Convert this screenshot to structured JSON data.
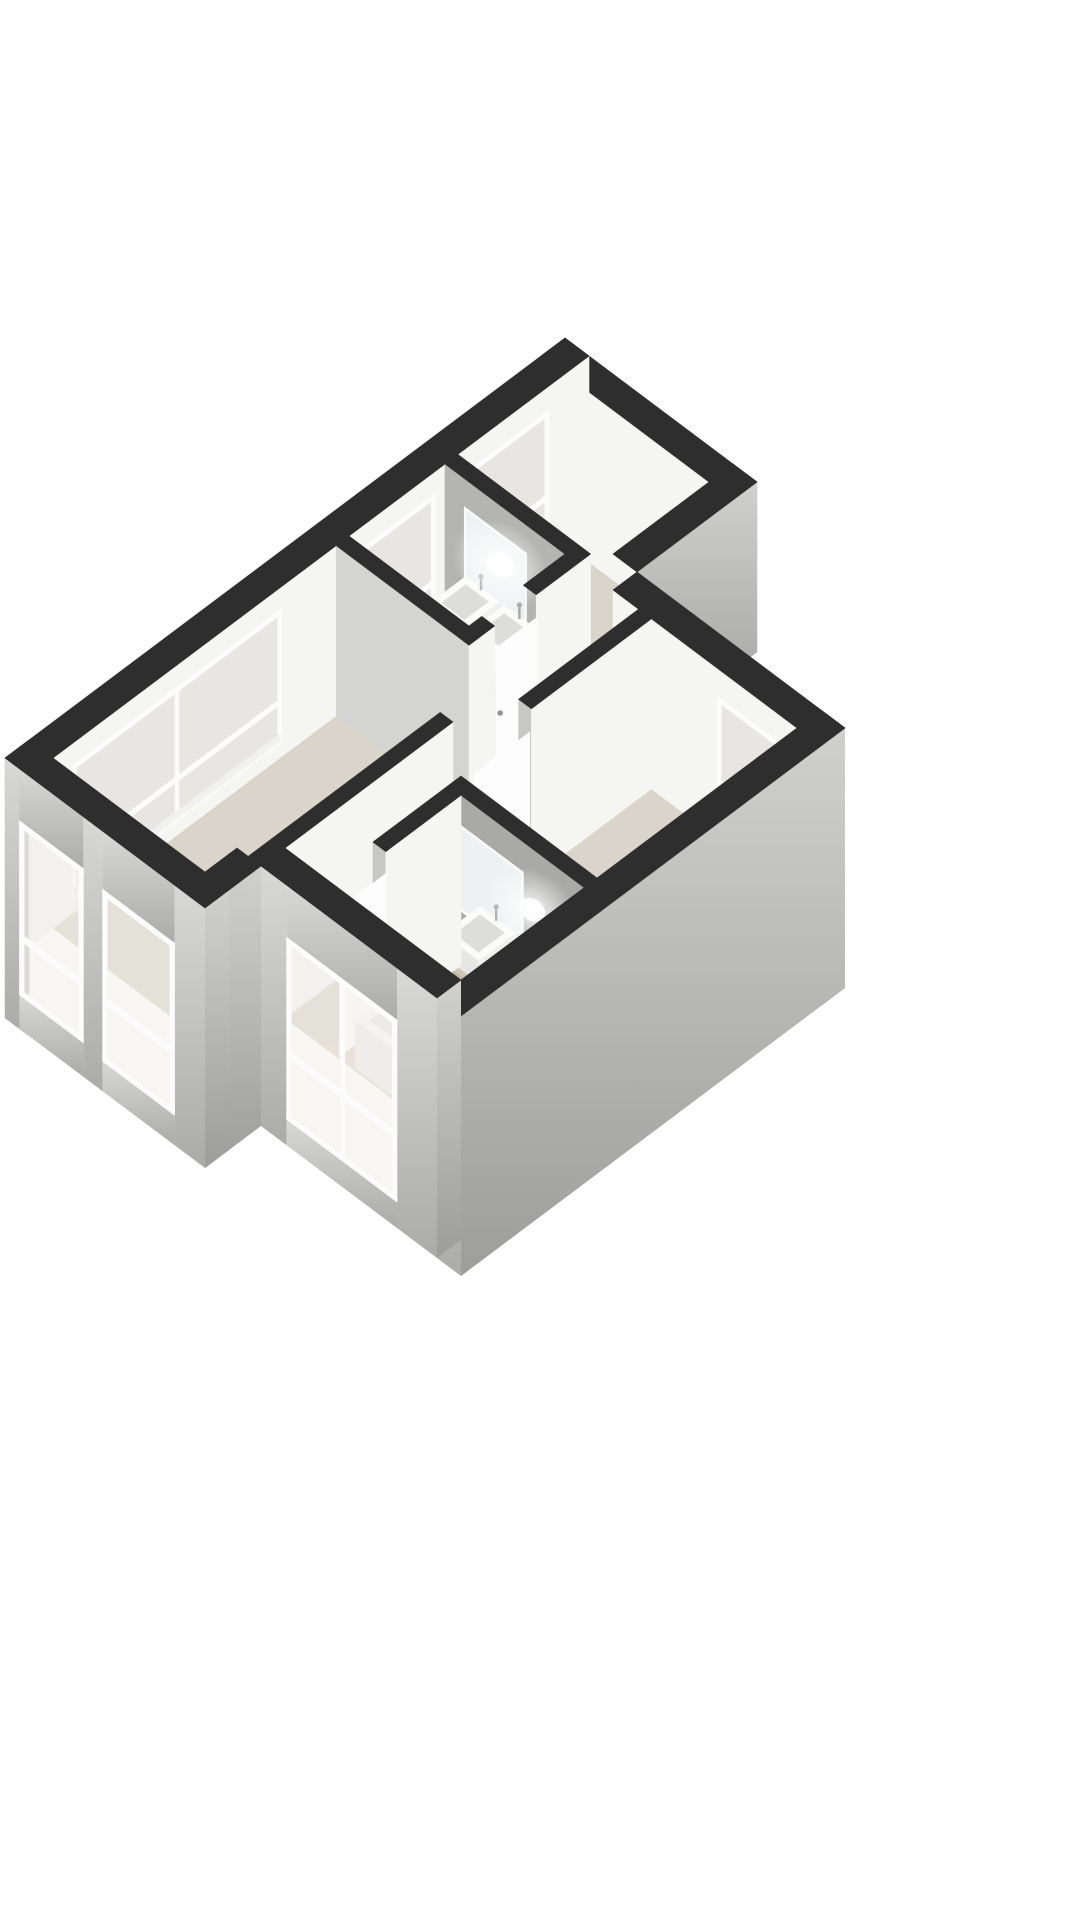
{
  "meta": {
    "title": "3D isometric floor plan render",
    "subject": "apartment floor with two bedrooms, living room, hallway and two bathrooms",
    "background": "#ffffff"
  },
  "palette": {
    "bg": "#ffffff",
    "wallTop": "#2e2e2e",
    "intWhite": "#f5f5f4",
    "intV": "#c7c7c6",
    "hallWall": "#d4d4d3",
    "bathWallA": "#b4b4b3",
    "bathWallB": "#a9a9a8",
    "extFlat": "#c9c9c8",
    "extUTop": "#d0d0cf",
    "extUBot": "#9d9d9c",
    "extVTop": "#d8d8d7",
    "extVBot": "#ababaa",
    "floor": "#d9d5ca",
    "floorBath": "#ded9cf",
    "glass": "#e7e6e2",
    "glassOut": "#efede8",
    "frame": "#fcfcfc",
    "sill": "#f1f1ef",
    "mirror": "#eef1f2",
    "mirrorFrame": "#fafafa",
    "counter": "#cfc8b4",
    "counterEdge": "#c1baa6",
    "cabinet": "#e7e2d5",
    "sinkTop": "#fbfbfa",
    "sinkSide": "#f0f0ef",
    "sinkFront": "#e7e7e6",
    "basin": "#dddddb",
    "door": "#fdfdfd",
    "handle": "#949493",
    "tubTop": "#f8f8f7",
    "tubInner": "#e9e9e8",
    "tubSide": "#f1f1f0",
    "tubFront": "#ededec",
    "towel": "#c9c9c8",
    "towelDark": "#b9b9b8",
    "faucet": "#a8a8a7",
    "glow": "#ffffff"
  },
  "scene": {
    "x0": 565,
    "y0": 338,
    "ax": 0.8,
    "ay": 0.6,
    "h": 170,
    "below": 90
  },
  "floors": [
    {
      "t": "floor",
      "name": "floor-bedroom-1",
      "r": [
        30,
        30,
        210,
        164
      ],
      "c": "floor"
    },
    {
      "t": "floor",
      "name": "floor-bathroom-1",
      "r": [
        30,
        180,
        180,
        300
      ],
      "c": "floorBath"
    },
    {
      "t": "floor",
      "name": "floor-hallway",
      "r": [
        180,
        164,
        316,
        446
      ],
      "c": "floor"
    },
    {
      "t": "floor",
      "name": "floor-bedroom-2",
      "r": [
        256,
        180,
        470,
        430
      ],
      "c": "floor"
    },
    {
      "t": "floor",
      "name": "floor-living-room",
      "r": [
        30,
        316,
        234,
        670
      ],
      "c": "floor"
    },
    {
      "t": "floor",
      "name": "floor-bathroom-2",
      "r": [
        300,
        430,
        470,
        600
      ],
      "c": "floorBath"
    },
    {
      "t": "floor",
      "name": "floor-corridor",
      "r": [
        234,
        446,
        300,
        600
      ],
      "c": "floor"
    }
  ],
  "elements": [
    {
      "t": "wall",
      "name": "wall-northeast",
      "r": [
        0,
        0,
        240,
        30
      ],
      "fv": "intWhite",
      "fu": "extFlat"
    },
    {
      "t": "wall",
      "name": "wall-northwest-facade",
      "r": [
        0,
        0,
        30,
        700
      ],
      "fu": "intWhite",
      "fv": "extFlat",
      "fvz": [
        -90,
        170
      ]
    },
    {
      "t": "winI",
      "name": "window-bedroom-1",
      "plane": "u",
      "at": 30,
      "a": [
        50,
        150
      ],
      "z": [
        26,
        146
      ],
      "transom": 60
    },
    {
      "t": "winI",
      "name": "window-bathroom-1",
      "plane": "u",
      "at": 30,
      "a": [
        192,
        292
      ],
      "z": [
        18,
        148
      ],
      "transom": 60
    },
    {
      "t": "winI",
      "name": "window-living-room",
      "plane": "u",
      "at": 30,
      "a": [
        384,
        646
      ],
      "z": [
        14,
        148
      ],
      "transom": 56,
      "mull": 515
    },
    {
      "t": "wall",
      "name": "wall-notch-east",
      "r": [
        210,
        0,
        240,
        150
      ],
      "fu": "gExtU"
    },
    {
      "t": "wall",
      "name": "wall-bedroom-2-north",
      "r": [
        240,
        150,
        500,
        180
      ],
      "fv": "intWhite",
      "fu": "gExtU",
      "fuz": [
        -90,
        170
      ]
    },
    {
      "t": "winI",
      "name": "window-bedroom-2",
      "plane": "v",
      "at": 180,
      "a": [
        370,
        455
      ],
      "z": [
        28,
        142
      ],
      "transom": 58
    },
    {
      "t": "wall",
      "name": "wall-bathroom-1-vanity",
      "r": [
        30,
        164,
        196,
        180
      ],
      "fv": "bathWallA",
      "fu": "intWhite"
    },
    {
      "t": "panel",
      "name": "mirror-bathroom-1",
      "plane": "v",
      "at": 181,
      "a": [
        58,
        130
      ],
      "z": [
        60,
        140
      ],
      "c": "mirror",
      "frame": true
    },
    {
      "t": "hpanel",
      "name": "counter-bathroom-1",
      "r": [
        50,
        180,
        152,
        238
      ],
      "z": 56,
      "c": "counter"
    },
    {
      "t": "panel",
      "name": "counter-edge-bathroom-1",
      "plane": "v",
      "at": 238,
      "a": [
        50,
        152
      ],
      "z": [
        46,
        56
      ],
      "c": "counterEdge"
    },
    {
      "t": "panel",
      "name": "cabinet-bathroom-1",
      "plane": "v",
      "at": 238,
      "a": [
        54,
        148
      ],
      "z": [
        12,
        46
      ],
      "c": "cabinet"
    },
    {
      "t": "box",
      "name": "sink-bathroom-1-left",
      "r": [
        60,
        184,
        102,
        228
      ],
      "z": [
        56,
        78
      ],
      "ct": "sinkTop",
      "cu": "sinkSide",
      "cv": "sinkFront",
      "inset": 7,
      "ci": "basin"
    },
    {
      "t": "box",
      "name": "sink-bathroom-1-right",
      "r": [
        108,
        184,
        150,
        228
      ],
      "z": [
        56,
        78
      ],
      "ct": "sinkTop",
      "cu": "sinkSide",
      "cv": "sinkFront",
      "inset": 7,
      "ci": "basin"
    },
    {
      "t": "faucet",
      "name": "faucet-icon",
      "u": 81,
      "v": 186
    },
    {
      "t": "faucet",
      "name": "faucet-icon",
      "u": 129,
      "v": 186
    },
    {
      "t": "glow",
      "name": "spotlight-bathroom-1",
      "u": 100,
      "v": 181,
      "z": 112,
      "rx": 52,
      "ry": 40,
      "rot": 37
    },
    {
      "t": "wall",
      "name": "wall-bathroom-1-south",
      "r": [
        30,
        300,
        196,
        316
      ],
      "fv": "hallWall",
      "fu": "intWhite"
    },
    {
      "t": "wall",
      "name": "wall-bathroom-1-east-a",
      "r": [
        180,
        180,
        196,
        232
      ],
      "fu": "intWhite"
    },
    {
      "t": "wall",
      "name": "wall-bathroom-1-east-b",
      "r": [
        180,
        284,
        196,
        300
      ],
      "fu": "intWhite"
    },
    {
      "t": "panel",
      "name": "door-bathroom-1",
      "plane": "u",
      "at": 197,
      "a": [
        232,
        284
      ],
      "z": [
        0,
        148
      ],
      "c": "door"
    },
    {
      "t": "handle",
      "name": "door-handle-icon",
      "u": 197,
      "v": 278,
      "z": 80
    },
    {
      "t": "wall",
      "name": "wall-bedroom-2-west",
      "r": [
        272,
        180,
        288,
        330
      ],
      "fu": "intWhite",
      "fv": "intV"
    },
    {
      "t": "panel",
      "name": "door-bedroom-2",
      "plane": "u",
      "at": 288,
      "a": [
        332,
        402
      ],
      "z": [
        0,
        148
      ],
      "c": "door"
    },
    {
      "t": "handle",
      "name": "door-handle-icon",
      "u": 288,
      "v": 396,
      "z": 80
    },
    {
      "t": "wall",
      "name": "wall-living-east",
      "r": [
        234,
        390,
        250,
        670
      ],
      "fu": "intWhite",
      "fv": "intV"
    },
    {
      "t": "wall",
      "name": "wall-bathroom-2-vanity",
      "r": [
        300,
        430,
        470,
        446
      ],
      "fv": "bathWallB"
    },
    {
      "t": "panel",
      "name": "mirror-bathroom-2",
      "plane": "v",
      "at": 447,
      "a": [
        318,
        392
      ],
      "z": [
        58,
        138
      ],
      "c": "mirror",
      "frame": true
    },
    {
      "t": "hpanel",
      "name": "counter-bathroom-2",
      "r": [
        336,
        446,
        462,
        502
      ],
      "z": 56,
      "c": "counter"
    },
    {
      "t": "panel",
      "name": "counter-edge-bathroom-2",
      "plane": "v",
      "at": 502,
      "a": [
        336,
        462
      ],
      "z": [
        46,
        56
      ],
      "c": "counterEdge"
    },
    {
      "t": "panel",
      "name": "cabinet-bathroom-2",
      "plane": "v",
      "at": 502,
      "a": [
        340,
        458
      ],
      "z": [
        12,
        46
      ],
      "c": "cabinet"
    },
    {
      "t": "box",
      "name": "sink-bathroom-2-left",
      "r": [
        344,
        450,
        388,
        496
      ],
      "z": [
        56,
        78
      ],
      "ct": "sinkTop",
      "cu": "sinkSide",
      "cv": "sinkFront",
      "inset": 7,
      "ci": "basin"
    },
    {
      "t": "box",
      "name": "sink-bathroom-2-right",
      "r": [
        402,
        450,
        446,
        496
      ],
      "z": [
        56,
        78
      ],
      "ct": "sinkTop",
      "cu": "sinkSide",
      "cv": "sinkFront",
      "inset": 7,
      "ci": "basin"
    },
    {
      "t": "faucet",
      "name": "faucet-icon",
      "u": 366,
      "v": 452
    },
    {
      "t": "faucet",
      "name": "faucet-icon",
      "u": 424,
      "v": 452
    },
    {
      "t": "glow",
      "name": "spotlight-bathroom-2",
      "u": 406,
      "v": 447,
      "z": 110,
      "rx": 50,
      "ry": 38,
      "rot": 37
    },
    {
      "t": "wall",
      "name": "wall-bathroom-2-west",
      "r": [
        300,
        446,
        316,
        540
      ],
      "fu": "intWhite",
      "fv": "intV"
    },
    {
      "t": "panel",
      "name": "door-bathroom-2",
      "plane": "u",
      "at": 316,
      "a": [
        540,
        598
      ],
      "z": [
        0,
        148
      ],
      "c": "door"
    },
    {
      "t": "handle",
      "name": "door-handle-icon",
      "u": 316,
      "v": 590,
      "z": 80
    },
    {
      "t": "box",
      "name": "bathtub",
      "r": [
        336,
        540,
        460,
        598
      ],
      "z": [
        0,
        48
      ],
      "ct": "tubTop",
      "cu": "tubSide",
      "cv": "tubFront",
      "inset": 9,
      "ci": "tubInner"
    },
    {
      "t": "hpanel",
      "name": "towel-on-bathtub",
      "r": [
        396,
        536,
        436,
        600
      ],
      "z": 50,
      "c": "towel"
    },
    {
      "t": "panel",
      "name": "towel-drape",
      "plane": "v",
      "at": 600,
      "a": [
        396,
        436
      ],
      "z": [
        24,
        50
      ],
      "c": "towelDark"
    },
    {
      "t": "wall",
      "name": "wall-southeast-facade",
      "r": [
        470,
        150,
        500,
        630
      ],
      "fu": "gExtU",
      "fuz": [
        -90,
        170
      ],
      "fv": "gExtV",
      "fvz": [
        -90,
        170
      ]
    },
    {
      "t": "wall",
      "name": "wall-south-facade",
      "r": [
        250,
        600,
        470,
        630
      ],
      "fu": "gExtU",
      "fuz": [
        -90,
        170
      ],
      "fv": "gExtV",
      "fvz": [
        -90,
        170
      ],
      "holesV": [
        {
          "a": [
            282,
            420
          ],
          "z": [
            -64,
            118
          ]
        }
      ]
    },
    {
      "t": "winO",
      "name": "window-bathroom-2-exterior",
      "plane": "v",
      "at": 630,
      "a": [
        282,
        420
      ],
      "z": [
        -64,
        118
      ],
      "mull": 352,
      "transom": 2
    },
    {
      "t": "wall",
      "name": "wall-southwest-step",
      "r": [
        220,
        630,
        250,
        700
      ],
      "fu": "gExtU",
      "fuz": [
        -90,
        170
      ]
    },
    {
      "t": "wall",
      "name": "wall-southwest-facade",
      "r": [
        0,
        670,
        250,
        700
      ],
      "fu": "gExtU",
      "fuz": [
        -90,
        170
      ],
      "fv": "gExtV",
      "fvz": [
        -90,
        170
      ],
      "holesV": [
        {
          "a": [
            18,
            98
          ],
          "z": [
            -56,
            118
          ]
        },
        {
          "a": [
            122,
            212
          ],
          "z": [
            -60,
            112
          ]
        }
      ]
    },
    {
      "t": "winO",
      "name": "window-living-exterior-1",
      "plane": "v",
      "at": 700,
      "a": [
        18,
        98
      ],
      "z": [
        -56,
        118
      ],
      "transom": 2
    },
    {
      "t": "winO",
      "name": "window-living-exterior-2",
      "plane": "v",
      "at": 700,
      "a": [
        122,
        212
      ],
      "z": [
        -60,
        112
      ],
      "transom": 2
    }
  ]
}
